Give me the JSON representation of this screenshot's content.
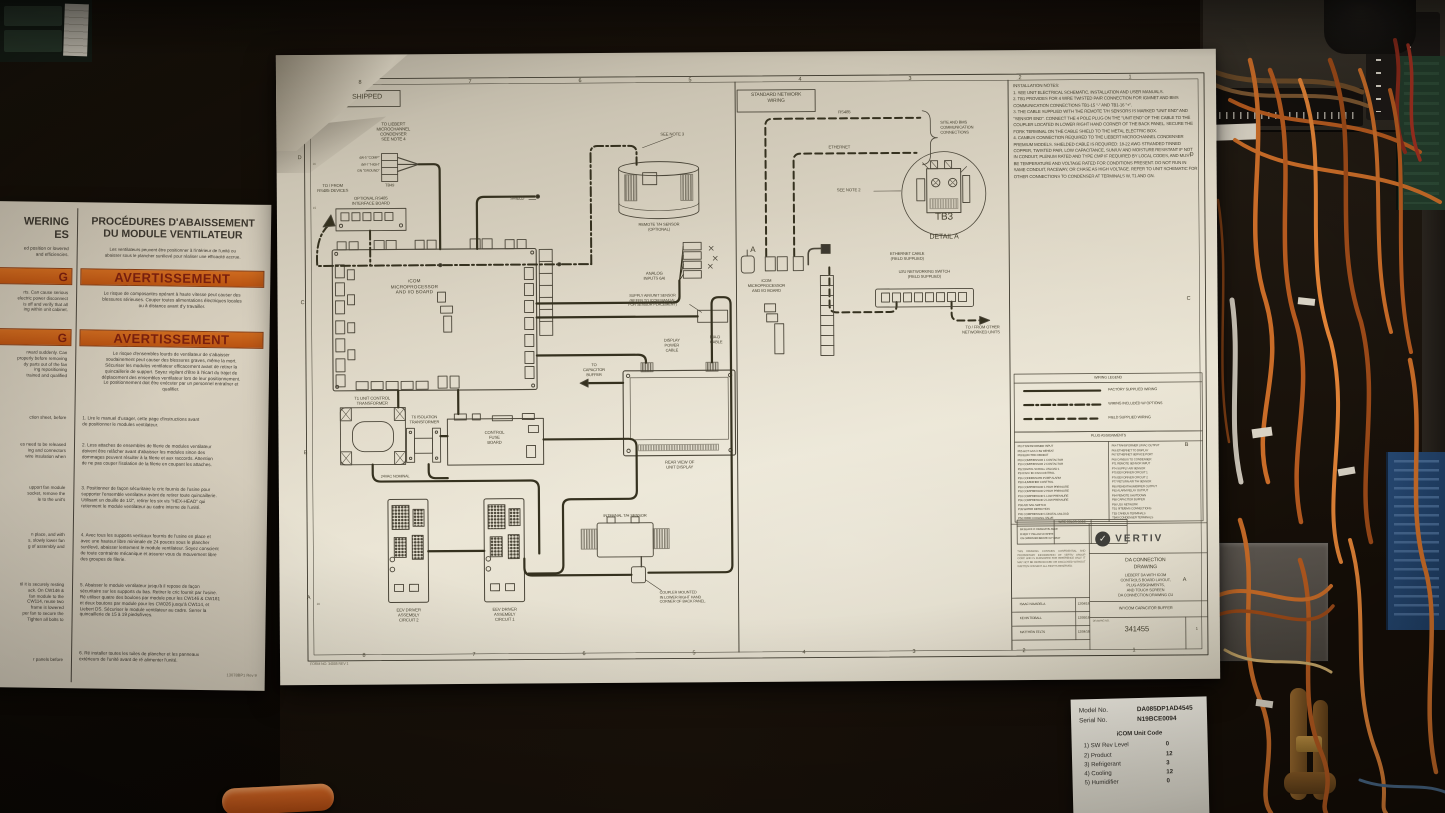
{
  "colors": {
    "paper": "#e9e3d2",
    "ink": "#3d3930",
    "warn_orange": "#c05a18",
    "warn_text": "#791f0e",
    "wire_orange": "#c96c28",
    "cabinet_bg": "#181209"
  },
  "drawing": {
    "panel_shipped": {
      "header": "SHIPPED",
      "cond_note": "TO LIEBERT\nMICROCHANNEL\nCONDENSER\nSEE NOTE 4",
      "tb49_pins": "4W-5 \"COMP\"\n4W-7 \"HIGH\"\nGN \"GROUND\"",
      "tb49": "TB49",
      "rs485_devices": "TO / FROM\nRS485 DEVICES",
      "rs485_board": "OPTIONAL RS485\nINTERFACE BOARD",
      "main_board": "iCOM\nMICROPROCESSOR\nAND I/O BOARD",
      "see_note3": "SEE NOTE 3",
      "remote_sensor": "REMOTE T/H SENSOR\n(OPTIONAL)",
      "shield": "SHIELD",
      "analog_inputs": "ANALOG\nINPUTS 6AI",
      "supply_air": "SUPPLY AIR/UNIT SENSOR\n(REFER TO ICOM MANUAL\nFOR SENSOR PLACEMENT)",
      "display_power": "DISPLAY\nPOWER\nCABLE",
      "dia_d": "DIA-D\nCABLE",
      "to_capacitor": "TO\nCAPACITOR\nBUFFER",
      "rear_view": "REAR VIEW OF\nUNIT DISPLAY",
      "t1": "T1 UNIT CONTROL\nTRANSFORMER",
      "t6": "T6 ISOLATION\nTRANSFORMER",
      "fuse_board": "CONTROL\nFUSE\nBOARD",
      "vac": "24VAC NOMINAL",
      "eev2": "EEV DRIVER\nASSEMBLY\nCIRCUIT 2",
      "eev1": "EEV DRIVER\nASSEMBLY\nCIRCUIT 1",
      "internal_sensor": "INTERNAL T/H SENSOR",
      "coupler": "COUPLER MOUNTED\nIN LOWER RIGHT HAND\nCORNER OF BACK PANEL.",
      "form_no": "FORM NO. 34005   REV 1"
    },
    "panel_network": {
      "header": "STANDARD NETWORK\nWIRING",
      "rs485": "RS485",
      "ethernet": "ETHERNET",
      "site_bms": "SITE AND BMS\nCOMMUNICATION\nCONNECTIONS",
      "see_note2": "SEE NOTE 2",
      "tb3": "TB3",
      "detail_a": "DETAIL A",
      "a_label": "A",
      "board": "iCOM\nMICROPROCESSOR\nAND I/O BOARD",
      "eth_cable": "ETHERNET CABLE\n(FIELD SUPPLIED)",
      "u2u": "U2U NETWORKING SWITCH\n(FIELD SUPPLIED)",
      "to_other": "TO / FROM OTHER\nNETWORKED UNITS"
    },
    "installation_notes": {
      "title": "INSTALLATION NOTES:",
      "items": [
        "1.  SEE UNIT ELECTRICAL SCHEMATIC, INSTALLATION AND USER MANUALS.",
        "2.  TB1 PROVIDES FOR 4 WIRE TWISTED PAIR CONNECTION FOR IGMNET AND BMS COMMUNICATION CONNECTIONS TB1-15 \"-\" AND TB1-16 \"+\".",
        "3.  THE CABLE SUPPLIED WITH THE REMOTE T/H SENSORS IS MARKED \"UNIT END\" AND \"SENSOR END\". CONNECT THE 4 POLE PLUG ON THE \"UNIT END\" OF THE CABLE TO THE COUPLER LOCATED IN LOWER RIGHT HAND CORNER OF THE BACK PANEL. SECURE THE FORK TERMINAL ON THE CABLE SHIELD TO THE METAL ELECTRIC BOX.",
        "4.  CANBUS CONNECTION REQUIRED TO THE LIEBERT MICROCHANNEL CONDENSER PREMIUM MODELS. SHIELDED CABLE IS REQUIRED: 18-22 AWG STRANDED TINNED COPPER, TWISTED PAIR, LOW CAPACITANCE, SUN/UV AND MOISTURE RESISTANT IF NOT IN CONDUIT, PLENUM RATED AND TYPE CMP IF REQUIRED BY LOCAL CODES, AND MUST BE TEMPERATURE AND VOLTAGE RATED FOR CONDITIONS PRESENT. DO NOT RUN IN SAME CONDUIT, RACEWAY, OR CHASE AS HIGH VOLTAGE. REFER TO UNIT SCHEMATIC FOR OTHER CONNECTIONS TO CONDENSER AT TERMINALS W, T1 AND GN."
      ]
    },
    "legend": {
      "title": "WIRING LEGEND",
      "factory": "FACTORY SUPPLIED WIRING",
      "options": "WIRING INCLUDED W/ OPTIONS",
      "field": "FIELD SUPPLIED WIRING"
    },
    "plug_table": {
      "title": "PLUG ASSIGNMENTS",
      "col1": [
        "P03  TRANSFORMER INPUT",
        "P05  HOT GAS / HW REHEAT",
        "P08  ELECTRIC REHEAT",
        "P09  COMPRESSOR 1 CONTACTOR",
        "P10  COMPRESSOR 2 CONTACTOR",
        "P22  DIGITAL SCROLL UNLOAD 1",
        "P24  FAN / EC FAN CONTROL",
        "P26  CONDENSATE PUMP ALARM",
        "P28  HUMIDIFIER CONTROL",
        "P30  COMPRESSOR 1 HIGH PRESSURE",
        "P32  COMPRESSOR 2 HIGH PRESSURE",
        "P33  COMPRESSOR 1 LOW PRESSURE",
        "P36  COMPRESSOR 2 LOW PRESSURE",
        "P38  AIR SAIL SWITCH",
        "P39  WATER DETECTION",
        "P45  COMPRESSOR 1 DIGITAL UNLOAD",
        "P52  FREE COOLING VALVE"
      ],
      "col2": [
        "P64  TRANSFORMER 24VAC OUTPUT",
        "P66  ETHERNET TO DISPLAY",
        "P67  ETHERNET SERVICE PORT",
        "P68  CANBUS TO CONDENSER",
        "P71  REMOTE SENSOR INPUT",
        "P74  SUPPLY AIR SENSOR",
        "P75  EEV DRIVER CIRCUIT 1",
        "P76  EEV DRIVER CIRCUIT 2",
        "P77  RETURN AIR T/H SENSOR",
        "P80  REHEAT/HUMIDIFIER OUTPUT",
        "P82  ALARM RELAY OUTPUT",
        "P84  REMOTE SHUTDOWN",
        "P88  CAPACITOR BUFFER",
        "P90  U2U NETWORK",
        "TB1  SITE/BMS CONNECTIONS",
        "TB3  CANBUS TERMINALS",
        "TB49 CONDENSER TERMINALS"
      ]
    },
    "wire_colors": {
      "title": "WIRE COLOR CODE",
      "rows": [
        "BK BLACK    O ORANGE    BL BLUE",
        "R RED         Y YELLOW    W WHITE",
        "GN GREEN   BR BROWN    GY GRAY"
      ]
    },
    "title_block": {
      "brand": "VERTIV",
      "title": "DA CONNECTION\nDRAWING",
      "subtitle": "LIEBERT DA WITH ICOM\nCONTROLS BOARD LAYOUT,\nPLUG ASSIGNMENTS,\nAND TOUCH SCREEN\nDA CONNECTION DRAWING CU",
      "option": "W/ ICOM CAPACITOR BUFFER",
      "dwg_label": "DRAWING NO.",
      "dwg_no": "341455",
      "sheet": "1",
      "proprietary": "THIS DRAWING CONTAINS CONFIDENTIAL AND PROPRIETARY INFORMATION OF VERTIV GROUP CORP. AND IS FURNISHED FOR REFERENCE ONLY. IT MAY NOT BE REPRODUCED OR DISCLOSED WITHOUT WRITTEN CONSENT. ALL RIGHTS RESERVED.",
      "signatures": [
        {
          "n": "ISAAC NAVARELA",
          "d": "12/04/18"
        },
        {
          "n": "KEVIN TIDBALL",
          "d": "12/05/18"
        },
        {
          "n": "MATTHEW FELTS",
          "d": "12/04/18"
        }
      ]
    },
    "rulers": {
      "top": [
        "8",
        "7",
        "6",
        "5",
        "4",
        "3",
        "2",
        "1"
      ],
      "bottom": [
        "8",
        "7",
        "6",
        "5",
        "4",
        "3",
        "2",
        "1"
      ],
      "left": [
        "D",
        "C",
        "B",
        "A"
      ],
      "right": [
        "D",
        "C",
        "B",
        "A"
      ],
      "minor": [
        "16",
        "15",
        "10"
      ]
    }
  },
  "warning_sheet": {
    "left_col": {
      "header": "WERING\nES",
      "header_sub": "ed position or lowered\nand efficiencies.",
      "warn": "G",
      "para1": "rts.  Can cause serious\nelectric power disconnect\nis off and verify that all\ning within unit cabinet.",
      "para2": "rward suddenly.  Can\nproperly before removing\ndy parts out of the fan\ning repositioning\ntrained and qualified",
      "item1": "ction sheet, before",
      "item2": "es need to be released\ning and connectors\nwire insulation when",
      "item3": "upport fan module\nsocket, remove the\nle to the unit's",
      "item4": "n place, and with\ns, slowly lower fan\ng of assembly and",
      "item5": "til it is securely resting\nack.  On CW146 &\nfan module to the\nCW114, reuse two\nframe is lowered\nper fan to secure the\nTighten all bolts to",
      "item6": "r panels before"
    },
    "right_col": {
      "header": "PROCÉDURES D'ABAISSEMENT\nDU MODULE VENTILATEUR",
      "header_sub": "Les ventilateurs peuvent être positionner à l'intérieur de l'unité ou\nabaisser sous le plancher surélevé pour réaliser une efficacité accrue.",
      "warn": "AVERTISSEMENT",
      "para1": "Le risque de composantes opérant à haute vitesse peut causer des\nblessures sérieuses.  Couper toutes alimentations électriques locales\nou à distance avant d'y travailler.",
      "para2": "Le risque d'ensembles lourds de ventilateur de s'abaisser\nsoudainement peut causer des blessures graves, même la mort.\nSécuriser les modules ventilateur efficacement avant de retirer la\nquincaillerie de support.  Soyez vigilant d'être à l'écart du trajet de\ndéplacement des ensembles ventilateur lors de leur positionnement.\nLe positionnement doit être exécuter par un personnel entraîner et\nqualifier.",
      "item1": "1. Lire le manuel d'usager, cette page d'instructions avant\nde positionner le modules ventilateur.",
      "item2": "2. Less attaches de ensembles de filerie de modules ventilateur\ndoivent être relâcher avant d'abaisser les modules sinon des\ndommages peuvent résulter à la filerie et aux raccords.  Attention\nde ne pas couper l'isolation de la filerie en coupant les attaches.",
      "item3": "3. Positionner de façon sécuritaire le cric fournis de l'usine pour\nsupporter l'ensemble ventilateur avant de retirer toute quincaillerie.\nUtilisant un douille de 1/2\", retirer les six vis \"HEX-HEAD\" qui\nretiennent le module ventilateur au cadre interne de l'unité.",
      "item4": "4. Avec tous les supports verticaux fournis de l'usine en place et\navec une hauteur libre minimale de 24 pouces sous le plancher\nsurélevé, abaisser lentement le module ventilateur.  Soyez conscient\nde toute contrainte mécanique et assurer vous du mouvement libre\ndes groupes de filerie.",
      "item5": "5. Abaisser le module ventilateur jusqu'à il repose de façon\nsécuritaire sur les supports du bas.  Retirer le cric fournit par l'usine.\nRé utiliser quatre des boulons par module pour les CW146 & CW181\net deux boutons par module pour les CW026 jusqu'à CW114, et\nLiebert DS.  Sécuriser le module ventilateur au cadre.  Serrer la\nquincaillerie de 15 à 19 pieds/livres.",
      "item6": "6. Ré installer toutes les tuiles de plancher et les panneaux\nextérieurs de l'unité avant de ré alimenter l'unité.",
      "footer": "13078BP1 Rev 9"
    }
  },
  "model_label": {
    "model_k": "Model No.",
    "model_v": "DA085DP1AD4545",
    "serial_k": "Serial No.",
    "serial_v": "N19BCE0094",
    "code_title": "iCOM Unit Code",
    "rows": [
      {
        "k": "1)  SW Rev Level",
        "v": "0"
      },
      {
        "k": "2)  Product",
        "v": "12"
      },
      {
        "k": "3)  Refrigerant",
        "v": "3"
      },
      {
        "k": "4)  Cooling",
        "v": "12"
      },
      {
        "k": "5)  Humidifier",
        "v": "0"
      }
    ]
  }
}
